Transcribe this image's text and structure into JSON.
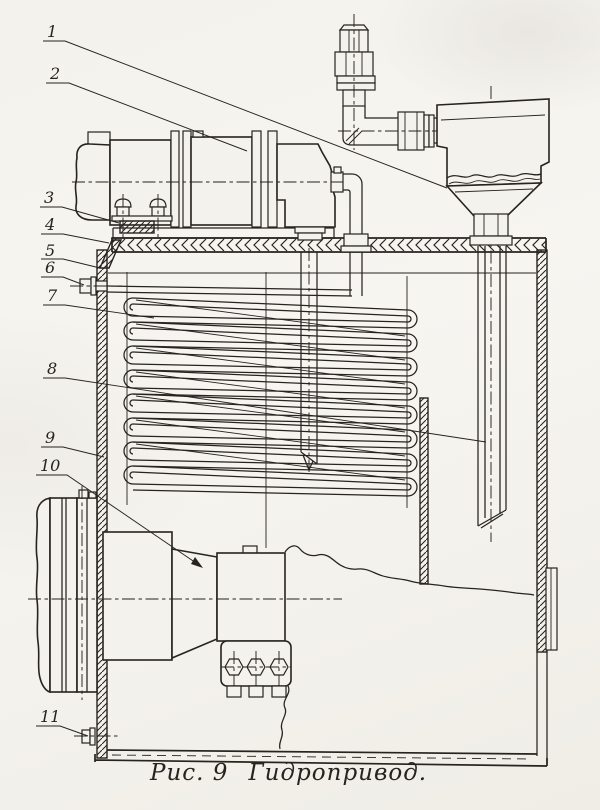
{
  "figure": {
    "caption_prefix": "Рис. 9",
    "caption_title": "Гидропривод."
  },
  "callouts": [
    {
      "label": "1"
    },
    {
      "label": "2"
    },
    {
      "label": "3"
    },
    {
      "label": "4"
    },
    {
      "label": "5"
    },
    {
      "label": "6"
    },
    {
      "label": "7"
    },
    {
      "label": "8"
    },
    {
      "label": "9"
    },
    {
      "label": "10"
    },
    {
      "label": "11"
    }
  ],
  "colors": {
    "ink": "#262320",
    "paper": "#f4f2ec"
  }
}
